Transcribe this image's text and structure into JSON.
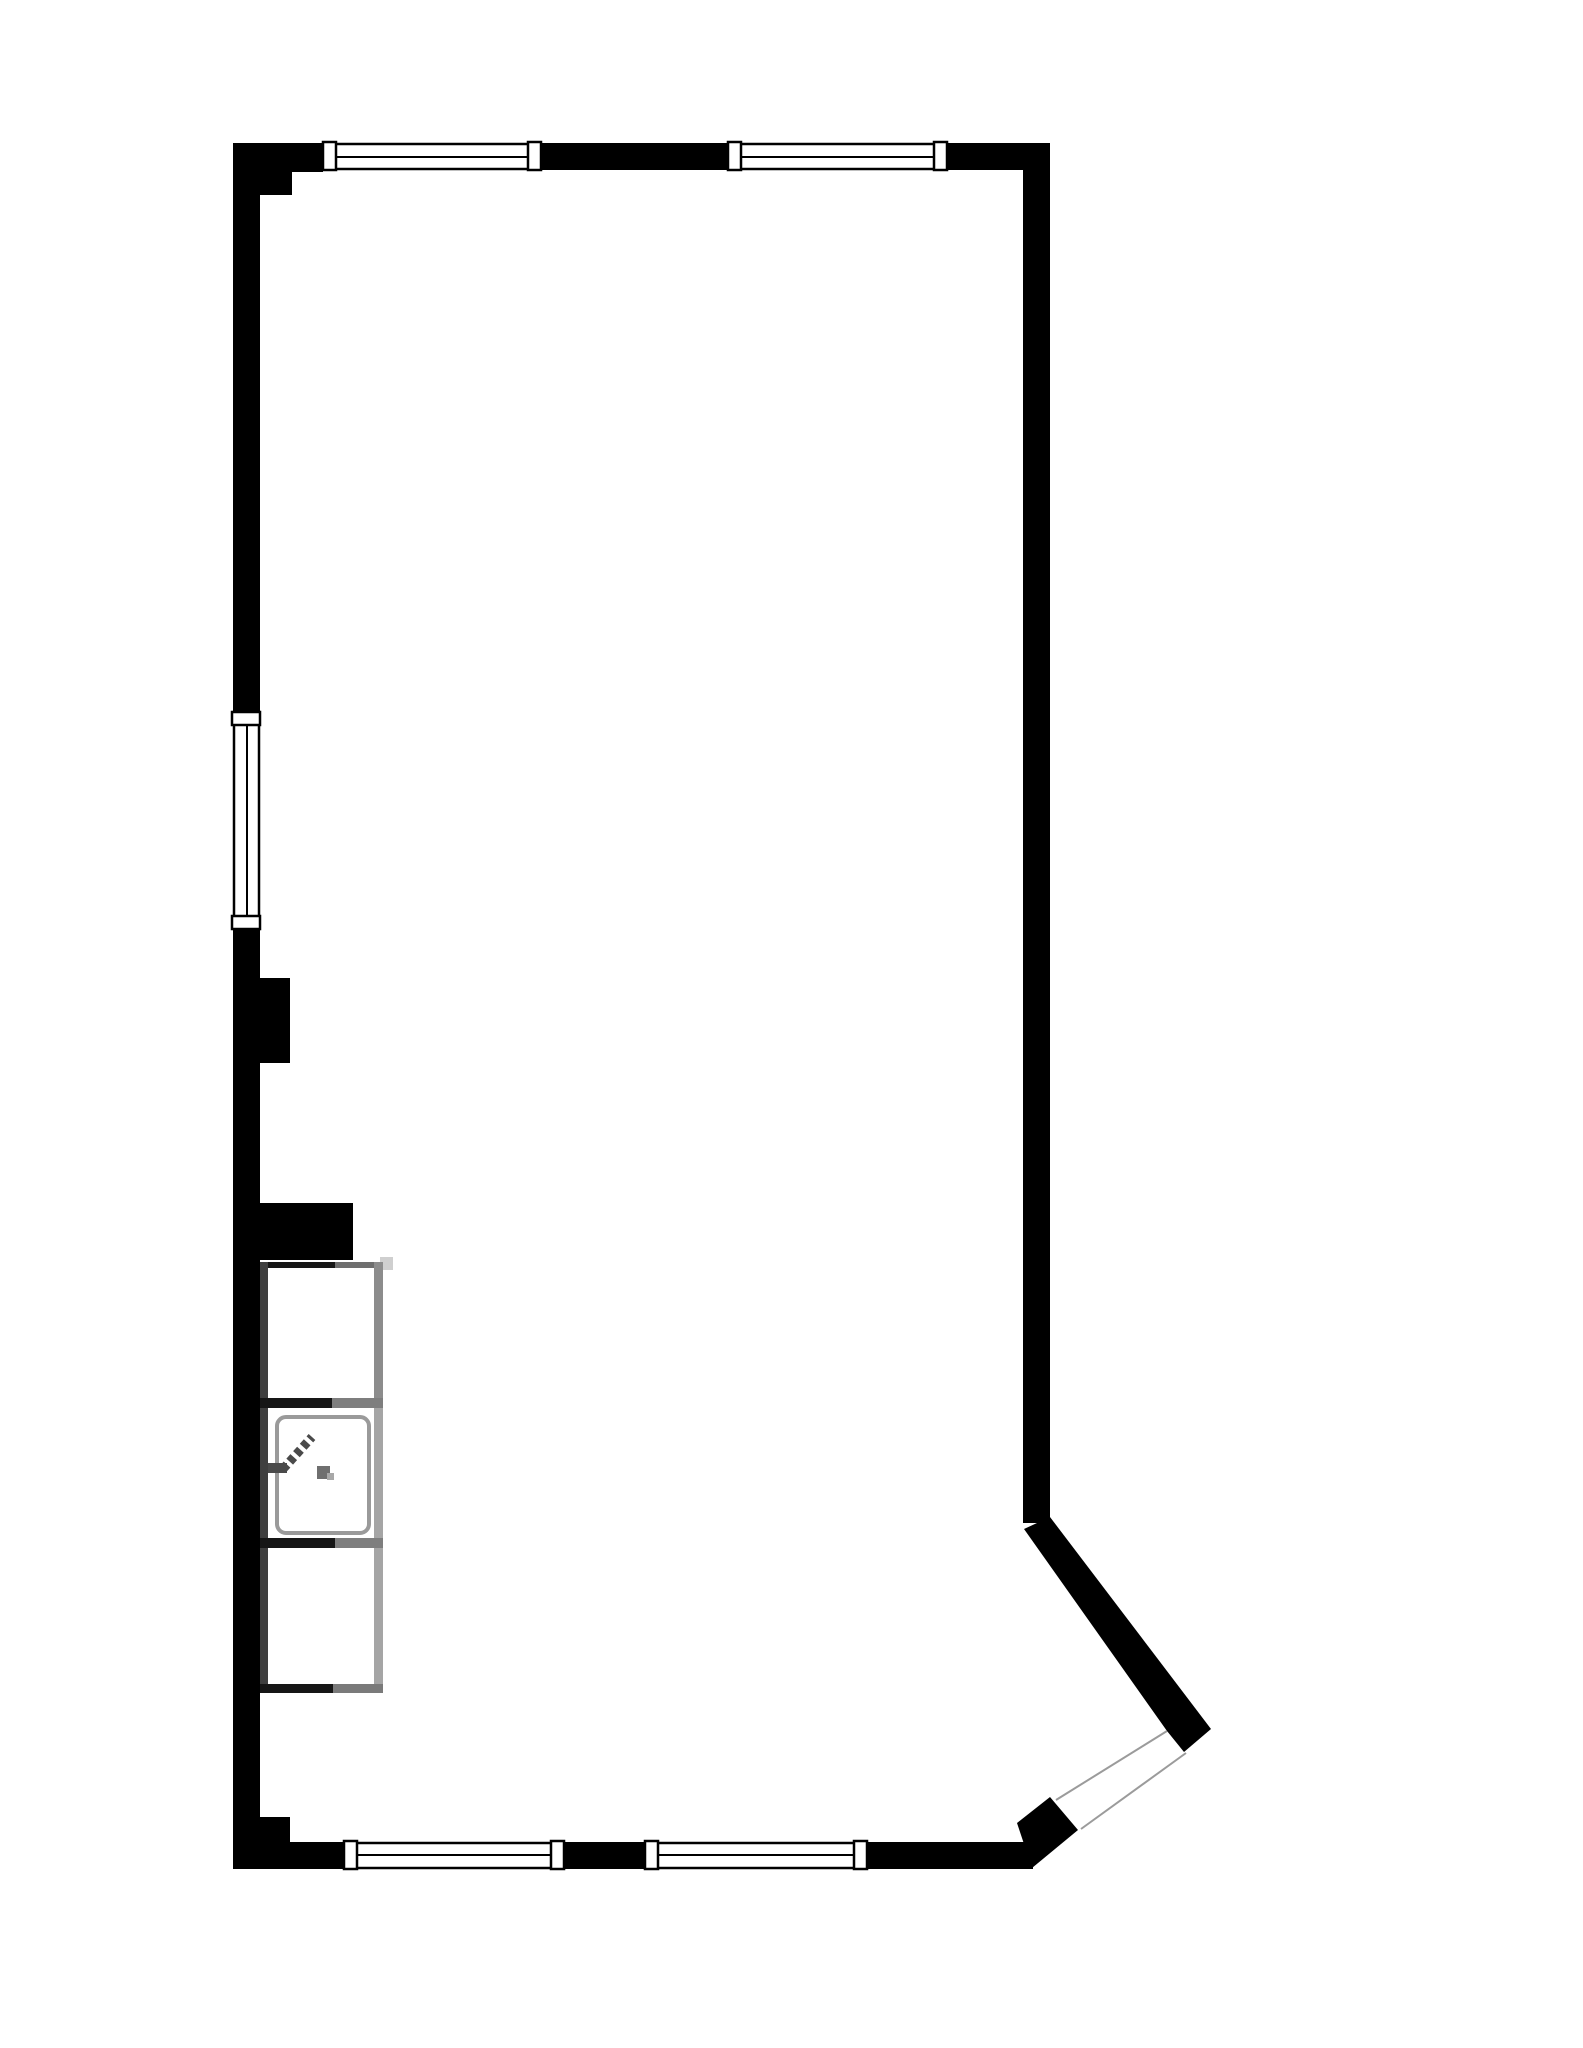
{
  "document": {
    "kind": "architectural-floor-plan",
    "background": "#ffffff"
  },
  "palette": {
    "wall": "#000000",
    "window_frame_fill": "#ffffff",
    "window_line": "#000000",
    "door_opening_line": "#9b9b9b",
    "fixture_dark": "#161616",
    "fixture_mid_dark": "#3f3f3f",
    "fixture_mid": "#7e7e7e",
    "fixture_light": "#a5a5a5",
    "fixture_faint": "#cfcfcf",
    "sink_outline": "#9a9a9a",
    "faucet": "#4a4a4a",
    "drain": "#6f6f6f"
  },
  "floorplan": {
    "canvas": {
      "width": 1583,
      "height": 2048,
      "viewbox": "0 0 1583 2048"
    },
    "layers": [
      {
        "name": "walls",
        "shapes": [
          {
            "name": "top-wall",
            "tag": "rect",
            "attrs": {
              "x": 233,
              "y": 143,
              "width": 817,
              "height": 27,
              "fill": "#000000"
            }
          },
          {
            "name": "left-wall",
            "tag": "rect",
            "attrs": {
              "x": 233,
              "y": 143,
              "width": 27,
              "height": 1726,
              "fill": "#000000"
            }
          },
          {
            "name": "right-wall",
            "tag": "rect",
            "attrs": {
              "x": 1023,
              "y": 143,
              "width": 27,
              "height": 1380,
              "fill": "#000000"
            }
          },
          {
            "name": "bottom-wall",
            "tag": "rect",
            "attrs": {
              "x": 233,
              "y": 1842,
              "width": 800,
              "height": 27,
              "fill": "#000000"
            }
          },
          {
            "name": "pilaster-top-outer",
            "tag": "rect",
            "attrs": {
              "x": 233,
              "y": 143,
              "width": 90,
              "height": 29,
              "fill": "#000000"
            }
          },
          {
            "name": "pilaster-top-inner",
            "tag": "rect",
            "attrs": {
              "x": 233,
              "y": 143,
              "width": 59,
              "height": 52,
              "fill": "#000000"
            }
          },
          {
            "name": "left-wall-bump",
            "tag": "rect",
            "attrs": {
              "x": 233,
              "y": 978,
              "width": 57,
              "height": 85,
              "fill": "#000000"
            }
          },
          {
            "name": "kitchen-wall-stub",
            "tag": "rect",
            "attrs": {
              "x": 233,
              "y": 1203,
              "width": 120,
              "height": 57,
              "fill": "#000000"
            }
          },
          {
            "name": "pilaster-bottom",
            "tag": "rect",
            "attrs": {
              "x": 233,
              "y": 1817,
              "width": 57,
              "height": 52,
              "fill": "#000000"
            }
          },
          {
            "name": "diagonal-wall",
            "tag": "polygon",
            "attrs": {
              "points": "1050,1517 1211,1729 1184,1752 1167,1731 1024,1529",
              "fill": "#000000"
            }
          },
          {
            "name": "door-jamb-block",
            "tag": "polygon",
            "attrs": {
              "points": "1017,1823 1050,1797 1078,1830 1032,1868",
              "fill": "#000000"
            }
          }
        ]
      },
      {
        "name": "door-opening",
        "shapes": [
          {
            "name": "door-opening-line-inner",
            "tag": "line",
            "attrs": {
              "x1": 1167,
              "y1": 1731,
              "x2": 1056,
              "y2": 1800,
              "stroke": "#9b9b9b",
              "stroke-width": 2
            }
          },
          {
            "name": "door-opening-line-outer",
            "tag": "line",
            "attrs": {
              "x1": 1186,
              "y1": 1753,
              "x2": 1081,
              "y2": 1829,
              "stroke": "#9b9b9b",
              "stroke-width": 2
            }
          }
        ]
      },
      {
        "name": "windows",
        "shapes": [
          {
            "name": "window-top-1-box",
            "tag": "rect",
            "attrs": {
              "x": 323,
              "y": 144,
              "width": 218,
              "height": 25,
              "fill": "#ffffff",
              "stroke": "#000000",
              "stroke-width": 2.5
            }
          },
          {
            "name": "window-top-1-midline",
            "tag": "line",
            "attrs": {
              "x1": 330,
              "y1": 157,
              "x2": 534,
              "y2": 157,
              "stroke": "#000000",
              "stroke-width": 2
            }
          },
          {
            "name": "window-top-1-frame-left",
            "tag": "rect",
            "attrs": {
              "x": 323,
              "y": 142,
              "width": 13,
              "height": 28,
              "fill": "#ffffff",
              "stroke": "#000000",
              "stroke-width": 2.5
            }
          },
          {
            "name": "window-top-1-frame-right",
            "tag": "rect",
            "attrs": {
              "x": 528,
              "y": 142,
              "width": 13,
              "height": 28,
              "fill": "#ffffff",
              "stroke": "#000000",
              "stroke-width": 2.5
            }
          },
          {
            "name": "window-top-2-box",
            "tag": "rect",
            "attrs": {
              "x": 728,
              "y": 144,
              "width": 219,
              "height": 25,
              "fill": "#ffffff",
              "stroke": "#000000",
              "stroke-width": 2.5
            }
          },
          {
            "name": "window-top-2-midline",
            "tag": "line",
            "attrs": {
              "x1": 735,
              "y1": 157,
              "x2": 940,
              "y2": 157,
              "stroke": "#000000",
              "stroke-width": 2
            }
          },
          {
            "name": "window-top-2-frame-left",
            "tag": "rect",
            "attrs": {
              "x": 728,
              "y": 142,
              "width": 13,
              "height": 28,
              "fill": "#ffffff",
              "stroke": "#000000",
              "stroke-width": 2.5
            }
          },
          {
            "name": "window-top-2-frame-right",
            "tag": "rect",
            "attrs": {
              "x": 934,
              "y": 142,
              "width": 13,
              "height": 28,
              "fill": "#ffffff",
              "stroke": "#000000",
              "stroke-width": 2.5
            }
          },
          {
            "name": "window-left-box",
            "tag": "rect",
            "attrs": {
              "x": 234,
              "y": 712,
              "width": 25,
              "height": 217,
              "fill": "#ffffff",
              "stroke": "#000000",
              "stroke-width": 2.5
            }
          },
          {
            "name": "window-left-midline",
            "tag": "line",
            "attrs": {
              "x1": 247,
              "y1": 719,
              "x2": 247,
              "y2": 922,
              "stroke": "#000000",
              "stroke-width": 2
            }
          },
          {
            "name": "window-left-frame-top",
            "tag": "rect",
            "attrs": {
              "x": 232,
              "y": 712,
              "width": 28,
              "height": 13,
              "fill": "#ffffff",
              "stroke": "#000000",
              "stroke-width": 2.5
            }
          },
          {
            "name": "window-left-frame-bottom",
            "tag": "rect",
            "attrs": {
              "x": 232,
              "y": 916,
              "width": 28,
              "height": 13,
              "fill": "#ffffff",
              "stroke": "#000000",
              "stroke-width": 2.5
            }
          },
          {
            "name": "window-bottom-1-box",
            "tag": "rect",
            "attrs": {
              "x": 344,
              "y": 1843,
              "width": 220,
              "height": 25,
              "fill": "#ffffff",
              "stroke": "#000000",
              "stroke-width": 2.5
            }
          },
          {
            "name": "window-bottom-1-midline",
            "tag": "line",
            "attrs": {
              "x1": 351,
              "y1": 1855,
              "x2": 557,
              "y2": 1855,
              "stroke": "#000000",
              "stroke-width": 2
            }
          },
          {
            "name": "window-bottom-1-frame-left",
            "tag": "rect",
            "attrs": {
              "x": 344,
              "y": 1841,
              "width": 13,
              "height": 28,
              "fill": "#ffffff",
              "stroke": "#000000",
              "stroke-width": 2.5
            }
          },
          {
            "name": "window-bottom-1-frame-right",
            "tag": "rect",
            "attrs": {
              "x": 551,
              "y": 1841,
              "width": 13,
              "height": 28,
              "fill": "#ffffff",
              "stroke": "#000000",
              "stroke-width": 2.5
            }
          },
          {
            "name": "window-bottom-2-box",
            "tag": "rect",
            "attrs": {
              "x": 645,
              "y": 1843,
              "width": 222,
              "height": 25,
              "fill": "#ffffff",
              "stroke": "#000000",
              "stroke-width": 2.5
            }
          },
          {
            "name": "window-bottom-2-midline",
            "tag": "line",
            "attrs": {
              "x1": 652,
              "y1": 1855,
              "x2": 860,
              "y2": 1855,
              "stroke": "#000000",
              "stroke-width": 2
            }
          },
          {
            "name": "window-bottom-2-frame-left",
            "tag": "rect",
            "attrs": {
              "x": 645,
              "y": 1841,
              "width": 13,
              "height": 28,
              "fill": "#ffffff",
              "stroke": "#000000",
              "stroke-width": 2.5
            }
          },
          {
            "name": "window-bottom-2-frame-right",
            "tag": "rect",
            "attrs": {
              "x": 854,
              "y": 1841,
              "width": 13,
              "height": 28,
              "fill": "#ffffff",
              "stroke": "#000000",
              "stroke-width": 2.5
            }
          }
        ]
      },
      {
        "name": "kitchen-counter",
        "shapes": [
          {
            "name": "counter-top-notch",
            "tag": "rect",
            "attrs": {
              "x": 380,
              "y": 1257,
              "width": 13,
              "height": 13,
              "fill": "#cfcfcf"
            }
          },
          {
            "name": "cabinet1-top-dark",
            "tag": "rect",
            "attrs": {
              "x": 260,
              "y": 1262,
              "width": 75,
              "height": 6,
              "fill": "#161616"
            }
          },
          {
            "name": "cabinet1-top-gray",
            "tag": "rect",
            "attrs": {
              "x": 335,
              "y": 1262,
              "width": 48,
              "height": 6,
              "fill": "#6e6e6e"
            }
          },
          {
            "name": "cabinet1-left-edge",
            "tag": "rect",
            "attrs": {
              "x": 260,
              "y": 1262,
              "width": 8,
              "height": 144,
              "fill": "#3f3f3f"
            }
          },
          {
            "name": "cabinet1-right-edge",
            "tag": "rect",
            "attrs": {
              "x": 374,
              "y": 1262,
              "width": 9,
              "height": 144,
              "fill": "#8c8c8c"
            }
          },
          {
            "name": "divider1-dark",
            "tag": "rect",
            "attrs": {
              "x": 260,
              "y": 1398,
              "width": 72,
              "height": 10,
              "fill": "#161616"
            }
          },
          {
            "name": "divider1-gray",
            "tag": "rect",
            "attrs": {
              "x": 332,
              "y": 1398,
              "width": 51,
              "height": 10,
              "fill": "#7e7e7e"
            }
          },
          {
            "name": "sink-cabinet-left-edge",
            "tag": "rect",
            "attrs": {
              "x": 260,
              "y": 1408,
              "width": 8,
              "height": 130,
              "fill": "#3f3f3f"
            }
          },
          {
            "name": "sink-cabinet-right-edge",
            "tag": "rect",
            "attrs": {
              "x": 374,
              "y": 1408,
              "width": 9,
              "height": 130,
              "fill": "#a5a5a5"
            }
          },
          {
            "name": "sink-basin",
            "tag": "rect",
            "attrs": {
              "x": 277,
              "y": 1417,
              "width": 92,
              "height": 116,
              "rx": 9,
              "fill": "#ffffff",
              "stroke": "#9a9a9a",
              "stroke-width": 4
            }
          },
          {
            "name": "faucet-base",
            "tag": "rect",
            "attrs": {
              "x": 268,
              "y": 1463,
              "width": 19,
              "height": 10,
              "fill": "#4a4a4a"
            }
          },
          {
            "name": "faucet-spout",
            "tag": "line",
            "attrs": {
              "x1": 283,
              "y1": 1469,
              "x2": 312,
              "y2": 1437,
              "stroke": "#4a4a4a",
              "stroke-width": 9,
              "stroke-dasharray": "6 4"
            }
          },
          {
            "name": "sink-drain",
            "tag": "rect",
            "attrs": {
              "x": 317,
              "y": 1466,
              "width": 13,
              "height": 13,
              "fill": "#6f6f6f"
            }
          },
          {
            "name": "sink-drain-dot",
            "tag": "rect",
            "attrs": {
              "x": 327,
              "y": 1473,
              "width": 7,
              "height": 7,
              "fill": "#a8a8a8"
            }
          },
          {
            "name": "divider2-dark",
            "tag": "rect",
            "attrs": {
              "x": 260,
              "y": 1538,
              "width": 75,
              "height": 10,
              "fill": "#161616"
            }
          },
          {
            "name": "divider2-gray",
            "tag": "rect",
            "attrs": {
              "x": 335,
              "y": 1538,
              "width": 48,
              "height": 10,
              "fill": "#7e7e7e"
            }
          },
          {
            "name": "cabinet3-left-edge",
            "tag": "rect",
            "attrs": {
              "x": 260,
              "y": 1548,
              "width": 8,
              "height": 144,
              "fill": "#3f3f3f"
            }
          },
          {
            "name": "cabinet3-right-edge",
            "tag": "rect",
            "attrs": {
              "x": 374,
              "y": 1548,
              "width": 9,
              "height": 144,
              "fill": "#a5a5a5"
            }
          },
          {
            "name": "cabinet3-bottom-dark",
            "tag": "rect",
            "attrs": {
              "x": 260,
              "y": 1684,
              "width": 73,
              "height": 9,
              "fill": "#161616"
            }
          },
          {
            "name": "cabinet3-bottom-gray",
            "tag": "rect",
            "attrs": {
              "x": 333,
              "y": 1684,
              "width": 50,
              "height": 9,
              "fill": "#7a7a7a"
            }
          }
        ]
      }
    ]
  }
}
